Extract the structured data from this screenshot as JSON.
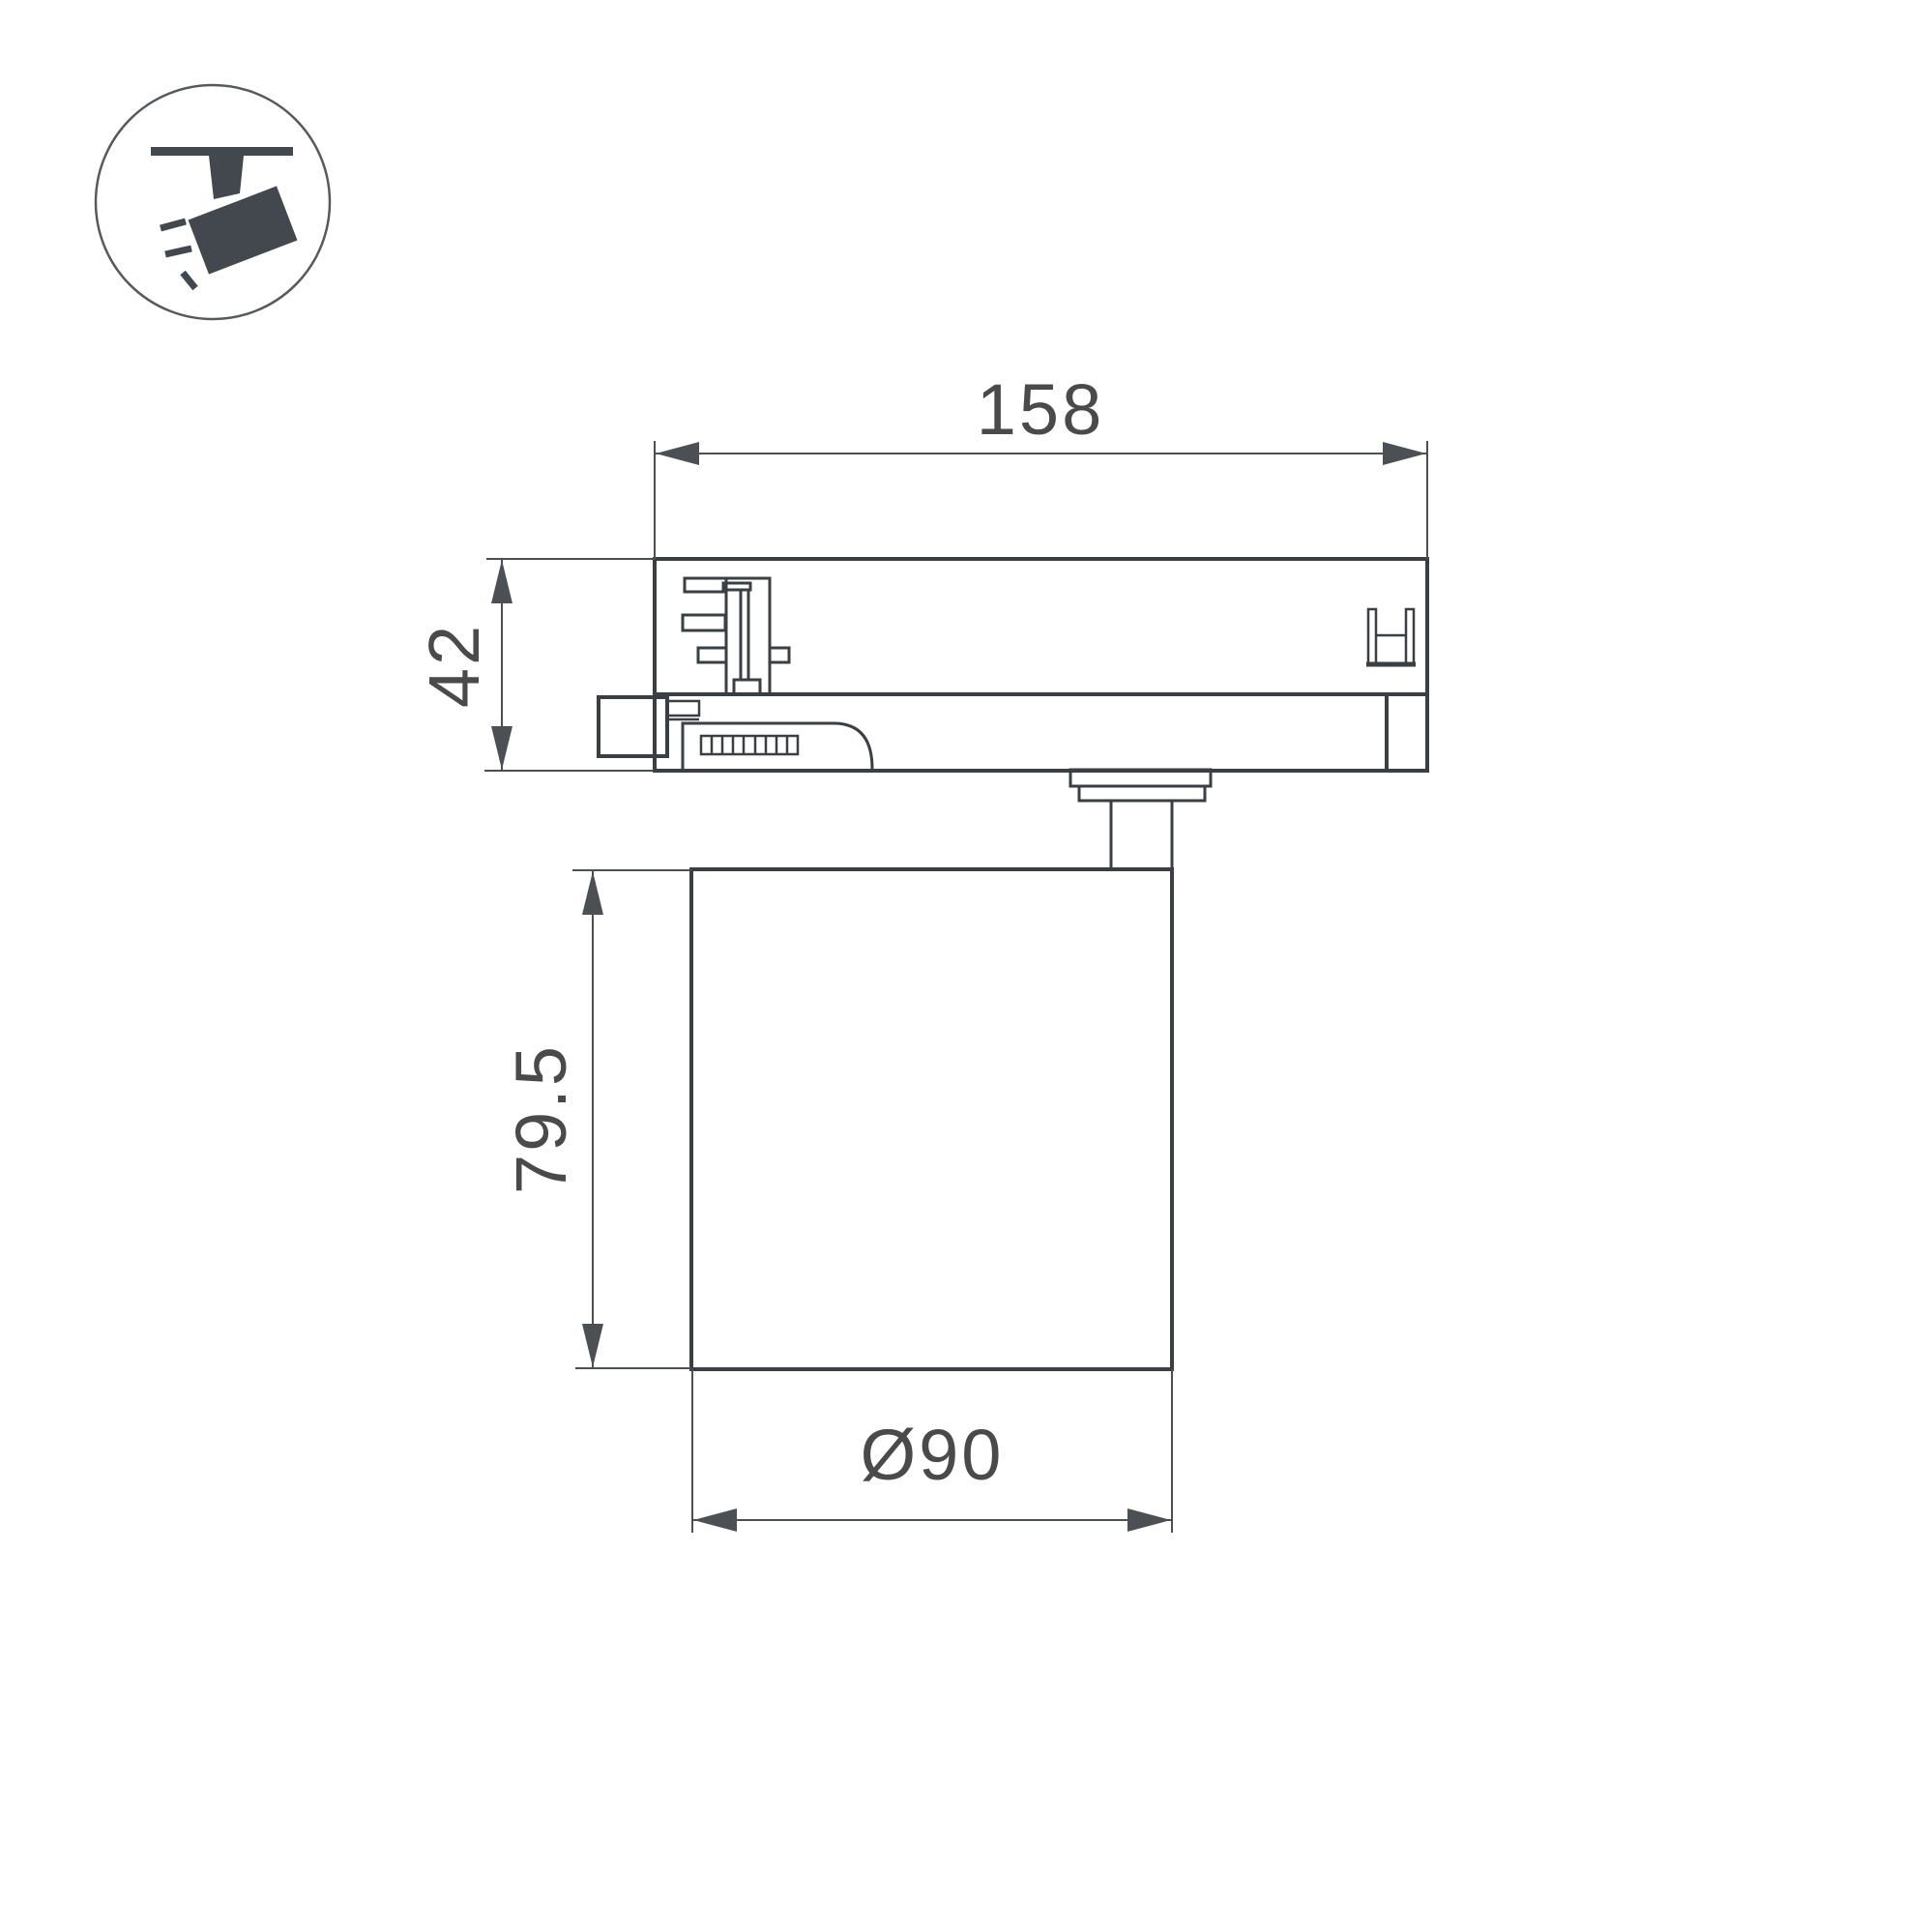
{
  "title": "track-spotlight-dimension-drawing",
  "colors": {
    "line": "#3a3f44",
    "dim": "#4c5054",
    "text": "#4a4a4a",
    "icon": "#42484e",
    "bg": "#ffffff"
  },
  "icon": {
    "name": "track-spotlight-icon",
    "meaning": "ceiling track with tilted spotlight emitting light rays"
  },
  "dimensions": {
    "adapter_width": "158",
    "adapter_height": "42",
    "body_height": "79.5",
    "body_diameter": "Ø90"
  }
}
